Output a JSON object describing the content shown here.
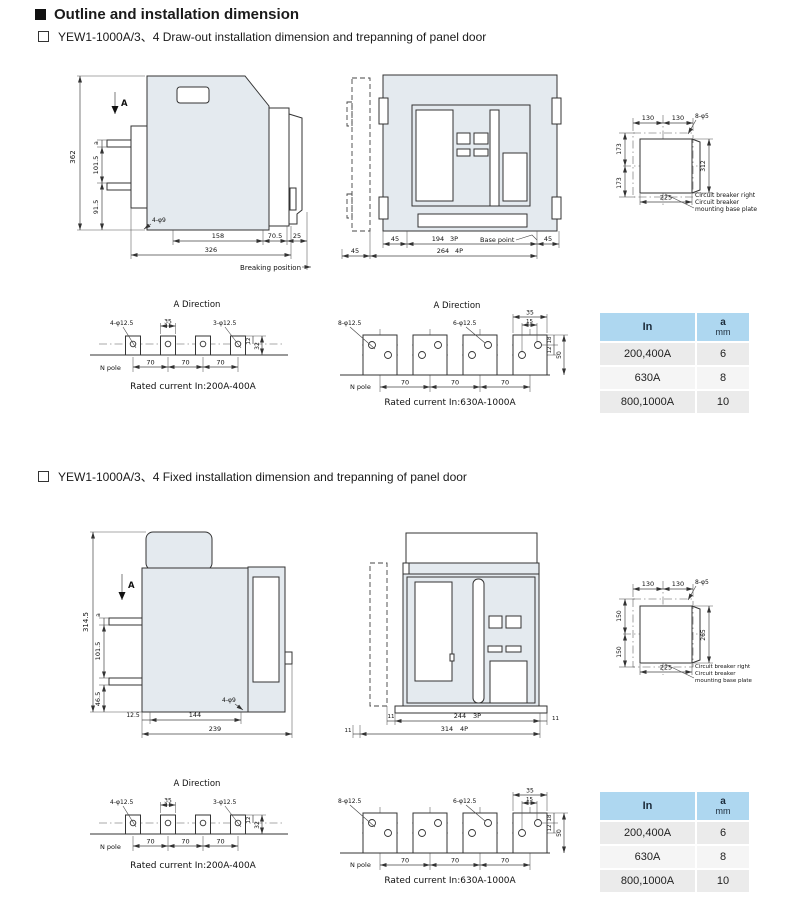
{
  "colors": {
    "drawing_fill": "#e4eaef",
    "table_header_bg": "#aed7f0",
    "table_header_text": "#1c2b3a",
    "table_row_bg": "#ebebeb",
    "table_row_alt_bg": "#f5f5f5"
  },
  "page": {
    "title": "Outline and installation dimension"
  },
  "sections": {
    "drawout": "YEW1-1000A/3、4 Draw-out installation dimension and trepanning of panel door",
    "fixed": "YEW1-1000A/3、4 Fixed installation dimension and trepanning of panel door"
  },
  "drawout": {
    "side": {
      "view_arrow": "A",
      "total_height": "362",
      "a": "a",
      "upper": "101.5",
      "lower": "91.5",
      "holes": "4-φ9",
      "w1": "158",
      "w2": "70.5",
      "w3": "25",
      "total_width": "326",
      "note": "Breaking position"
    },
    "front": {
      "left45": "45",
      "w3p": "194",
      "p3": "3P",
      "base_point": "Base point",
      "right45": "45",
      "w4p": "264",
      "p4": "4P",
      "bottom45": "45"
    },
    "cutout": {
      "top1": "130",
      "top2": "130",
      "holes": "8-φ5",
      "left1": "173",
      "left2": "173",
      "right": "312",
      "bottom": "225",
      "note1": "Circuit breaker right",
      "note2": "Circuit breaker",
      "note3": "mounting base plate"
    }
  },
  "fixed": {
    "side": {
      "view_arrow": "A",
      "total_height": "314.5",
      "a": "a",
      "upper": "101.5",
      "lower": "46.5",
      "b1": "12.5",
      "b2": "144",
      "total_width": "239",
      "holes": "4-φ9"
    },
    "front": {
      "left11": "11",
      "w3p": "244",
      "p3": "3P",
      "right11": "11",
      "w4p": "314",
      "p4": "4P",
      "bottom11": "11"
    },
    "cutout": {
      "top1": "130",
      "top2": "130",
      "holes": "8-φ5",
      "left1": "150",
      "left2": "150",
      "right": "265",
      "bottom": "225",
      "note1": "Circuit breaker right",
      "note2": "Circuit breaker",
      "note3": "mounting base plate"
    }
  },
  "adir_small": {
    "title": "A Direction",
    "holes_left": "4-φ12.5",
    "w35": "35",
    "holes_right": "3-φ12.5",
    "d12": "12",
    "d32": "32",
    "npole": "N pole",
    "pitch": "70",
    "caption": "Rated current In:200A-400A"
  },
  "adir_large": {
    "title": "A Direction",
    "holes_left": "8-φ12.5",
    "holes_mid": "6-φ12.5",
    "w35": "35",
    "w15": "15",
    "d18": "18",
    "d12": "12",
    "d50": "50",
    "npole": "N pole",
    "pitch": "70",
    "caption": "Rated current In:630A-1000A"
  },
  "table": {
    "col_in": "In",
    "col_a": "a",
    "col_a_unit": "mm",
    "rows": [
      {
        "current": "200,400A",
        "a": "6"
      },
      {
        "current": "630A",
        "a": "8"
      },
      {
        "current": "800,1000A",
        "a": "10"
      }
    ]
  }
}
